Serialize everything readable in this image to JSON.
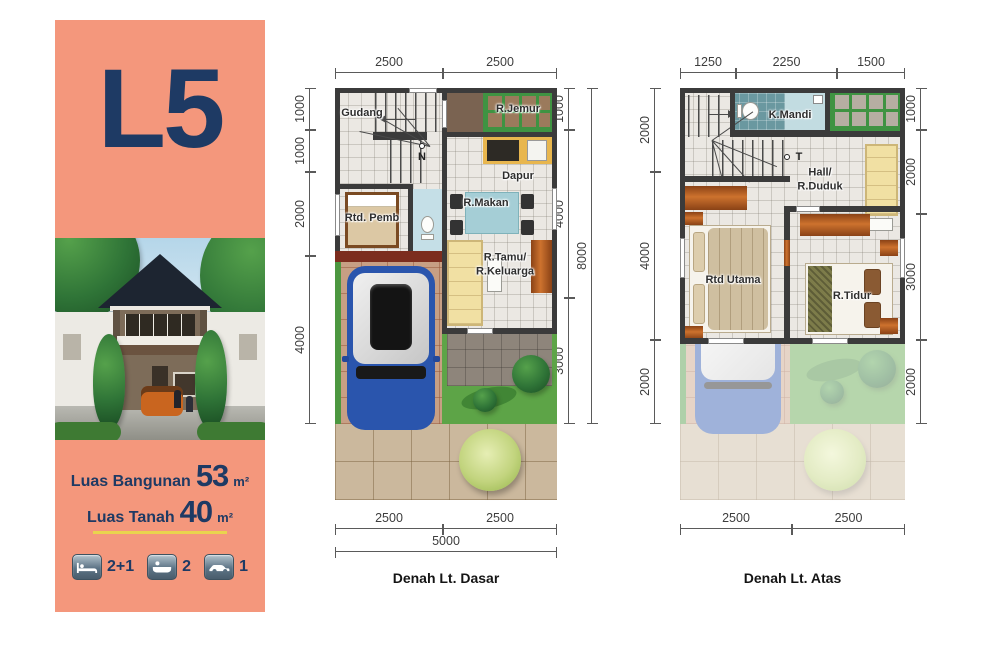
{
  "sidebar": {
    "unit_label": "L5",
    "colors": {
      "bg": "#f4977c",
      "accent": "#1e3a64",
      "divider": "#e9d44e"
    },
    "specs": [
      {
        "label": "Luas Bangunan",
        "value": "53",
        "unit": "m²"
      },
      {
        "label": "Luas Tanah",
        "value": "40",
        "unit": "m²"
      }
    ],
    "features": [
      {
        "icon": "bed-icon",
        "count": "2+1"
      },
      {
        "icon": "bath-icon",
        "count": "2"
      },
      {
        "icon": "car-icon",
        "count": "1"
      }
    ]
  },
  "ground_floor": {
    "title": "Denah Lt. Dasar",
    "dims": {
      "top": [
        "2500",
        "2500"
      ],
      "left": [
        "1000",
        "1000",
        "2000",
        "4000"
      ],
      "right_inner": [
        "1000",
        "4000",
        "3000"
      ],
      "right_outer": "8000",
      "bottom": [
        "2500",
        "2500"
      ],
      "bottom_total": "5000"
    },
    "labels": {
      "gudang": "Gudang",
      "jemur": "R.Jemur",
      "dapur": "Dapur",
      "pembantu": "Rtd. Pemb",
      "makan": "R.Makan",
      "tamu_line1": "R.Tamu/",
      "tamu_line2": "R.Keluarga",
      "north": "N"
    }
  },
  "upper_floor": {
    "title": "Denah Lt. Atas",
    "dims": {
      "top": [
        "1250",
        "2250",
        "1500"
      ],
      "left": [
        "2000",
        "4000",
        "2000"
      ],
      "right": [
        "1000",
        "2000",
        "3000",
        "2000"
      ],
      "bottom": [
        "2500",
        "2500"
      ]
    },
    "labels": {
      "kmandi": "K.Mandi",
      "hall_line1": "Hall/",
      "hall_line2": "R.Duduk",
      "utama": "Rtd Utama",
      "tidur": "R.Tidur",
      "t_marker": "T"
    }
  }
}
